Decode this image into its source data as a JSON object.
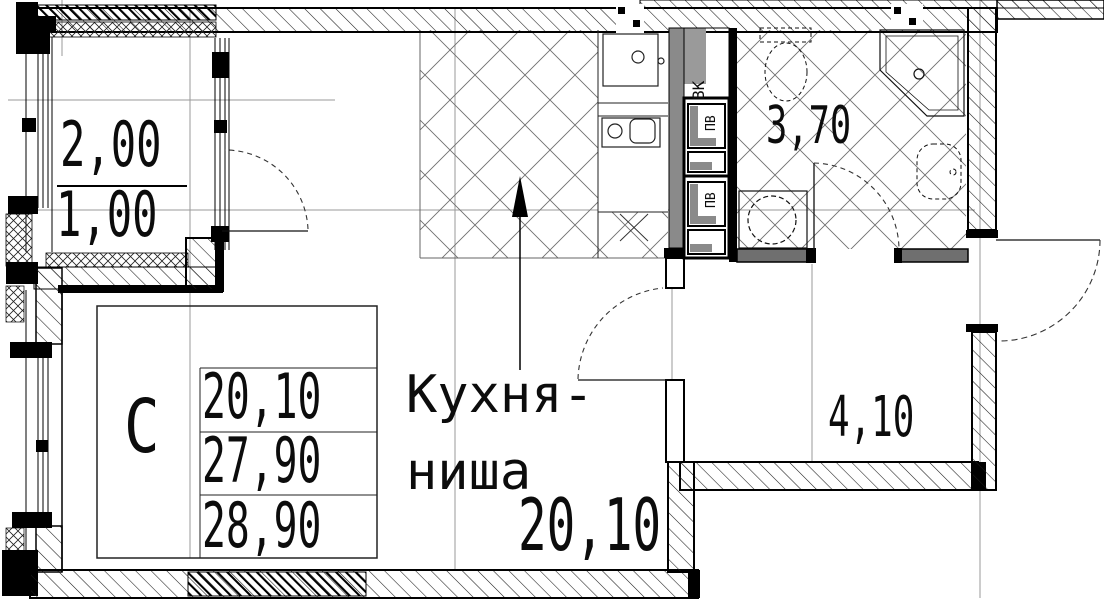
{
  "rooms": {
    "balcony": {
      "area_total": "2,00",
      "area_reduced": "1,00"
    },
    "bathroom": {
      "area": "3,70"
    },
    "hallway": {
      "area": "4,10"
    },
    "kitchen_niche": {
      "label_line1": "Кухня-",
      "label_line2": "ниша",
      "area": "20,10"
    }
  },
  "shafts": {
    "vent_label": "ВК",
    "duct_label_1": "ПВ",
    "duct_label_2": "ПВ"
  },
  "info_table": {
    "type": "С",
    "rows": [
      "20,10",
      "27,90",
      "28,90"
    ]
  },
  "colors": {
    "line": "#000000",
    "shaft_gray": "#8a8a8a",
    "wall_gray": "#6f6f6f",
    "grid_gray": "#9a9a9a",
    "background": "#ffffff"
  }
}
